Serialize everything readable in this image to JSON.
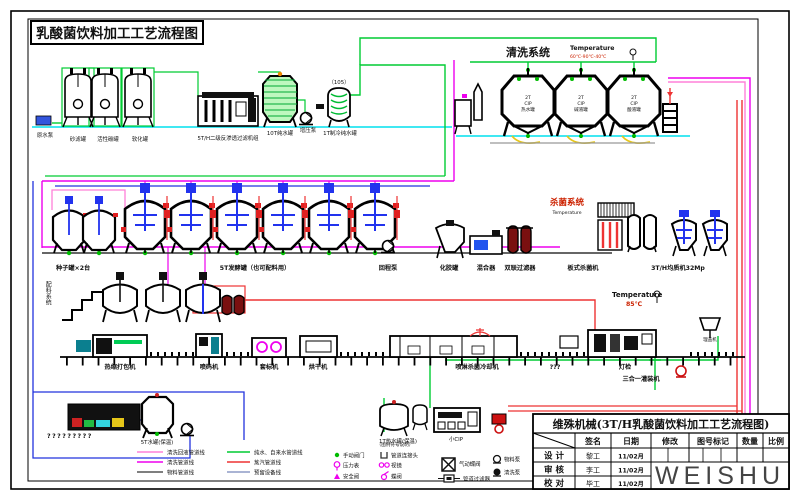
{
  "title_box": "乳酸菌饮料加工工艺流程图",
  "water": {
    "pump": "原水泵",
    "tank_sand": "砂滤罐",
    "tank_carbon": "活性碳罐",
    "tank_soft": "软化罐",
    "ro_unit": "5T/H二级反渗透过滤机组",
    "tank_10t": "10T纯水罐",
    "booster_pump": "增压泵",
    "tag_105": "（105）",
    "tank_1t": "1T制冷纯水罐"
  },
  "cip": {
    "title": "清洗系统",
    "temp_label": "Temperature",
    "temp_value": "60℃-90℃-40℃",
    "tank1": {
      "l1": "2T",
      "l2": "CIP",
      "l3": "热水罐"
    },
    "tank2": {
      "l1": "2T",
      "l2": "CIP",
      "l3": "碱液罐"
    },
    "tank3": {
      "l1": "2T",
      "l2": "CIP",
      "l3": "酸液罐"
    }
  },
  "ferment": {
    "seed_tanks": "种子罐×2台",
    "fermenters": "5T发酵罐（也可配料用）",
    "return_pump": "回程泵",
    "gel_tank": "化胶罐",
    "mixer": "混合器",
    "duplex_filter": "双联过滤器"
  },
  "sterilize": {
    "title": "杀菌系统",
    "temp_label": "Temperature",
    "plate": "板式杀菌机",
    "homogenizer": "3T/H均质机32Mp"
  },
  "batching": {
    "label": "配料系统"
  },
  "pack": {
    "shrink_wrapper": "热缩打包机",
    "coder": "喷码机",
    "sleever": "套标机",
    "dryer": "烘干机",
    "spray_cooler": "喷淋杀菌冷却机",
    "unknown": "???",
    "light_check": "灯检",
    "filler": "三合一灌装机",
    "cap_sorter": "理盖机",
    "temp_label": "Temperature",
    "temp_value": "85℃"
  },
  "bottom": {
    "qmarks": "?????????",
    "tank_5t": "5T水罐(保温)",
    "tank_1t_hot": "1T热水罐(保温)",
    "small_cip": "小CIP"
  },
  "legend": {
    "note": "（图例符号说明）",
    "lines": [
      {
        "label": "清洗回液管道线",
        "color": "#ff80d8"
      },
      {
        "label": "清洗管道线",
        "color": "#ee00ee"
      },
      {
        "label": "物料管道线",
        "color": "#555555"
      },
      {
        "label": "纯水、自来水管道线",
        "color": "#00cc33"
      },
      {
        "label": "蒸汽管道线",
        "color": "#ee3333"
      },
      {
        "label": "预留设备线",
        "color": "#7788bb"
      }
    ],
    "symbols": [
      "手动阀门",
      "压力表",
      "安全阀",
      "管道连接头",
      "视镜",
      "蝶阀",
      "气动蝶阀",
      "管道过滤器",
      "物料泵",
      "清洗泵"
    ]
  },
  "titleblock": {
    "title": "维殊机械(3T/H乳酸菌饮料加工工艺流程图)",
    "col_sign": "签名",
    "col_date": "日期",
    "col_mod": "修改",
    "col_dwg": "图号标记",
    "col_qty": "数量",
    "col_scale": "比例",
    "rows": [
      {
        "role": "设 计",
        "name": "黎工",
        "date": "11/02月"
      },
      {
        "role": "审 核",
        "name": "李工",
        "date": "11/02月"
      },
      {
        "role": "校 对",
        "name": "毕工",
        "date": "11/02月"
      }
    ],
    "logo": "WEISHU"
  }
}
